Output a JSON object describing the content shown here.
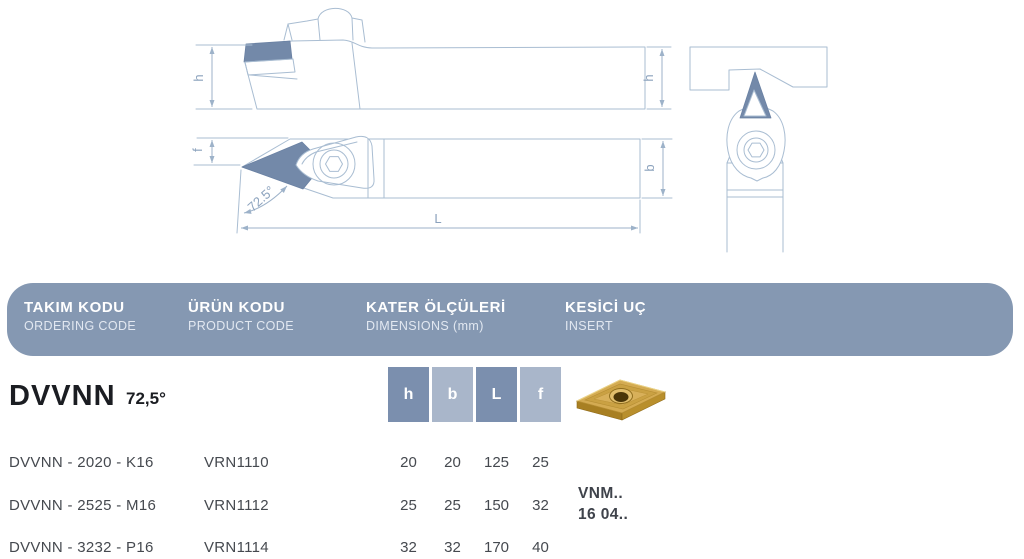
{
  "drawings": {
    "side_view": {
      "dim_left": "h",
      "dim_right": "h"
    },
    "top_view": {
      "dim_f": "f",
      "dim_b": "b",
      "dim_length": "L",
      "angle": "72.5°"
    },
    "line_color": "#a9bdd2",
    "insert_fill_color": "#7389a9"
  },
  "header": {
    "bg_color": "#8598b2",
    "columns": [
      {
        "title": "TAKIM KODU",
        "subtitle": "ORDERING CODE"
      },
      {
        "title": "ÜRÜN KODU",
        "subtitle": "PRODUCT CODE"
      },
      {
        "title": "KATER ÖLÇÜLERİ",
        "subtitle": "DIMENSIONS (mm)"
      },
      {
        "title": "KESİCİ UÇ",
        "subtitle": "INSERT"
      }
    ]
  },
  "series": {
    "code": "DVVNN",
    "angle": "72,5°"
  },
  "dim_headers": [
    {
      "label": "h",
      "shade": "dark"
    },
    {
      "label": "b",
      "shade": "light"
    },
    {
      "label": "L",
      "shade": "dark"
    },
    {
      "label": "f",
      "shade": "light"
    }
  ],
  "insert": {
    "photo": "gold-vnmg-insert",
    "code_line1": "VNM..",
    "code_line2": "16 04.."
  },
  "table": {
    "rows": [
      {
        "ordering_code": "DVVNN - 2020 - K16",
        "product_code": "VRN1110",
        "dims": [
          "20",
          "20",
          "125",
          "25"
        ]
      },
      {
        "ordering_code": "DVVNN - 2525 - M16",
        "product_code": "VRN1112",
        "dims": [
          "25",
          "25",
          "150",
          "32"
        ]
      },
      {
        "ordering_code": "DVVNN - 3232 - P16",
        "product_code": "VRN1114",
        "dims": [
          "32",
          "32",
          "170",
          "40"
        ]
      }
    ]
  },
  "colors": {
    "header_bg": "#8598b2",
    "box_dark": "#7b8fae",
    "box_light": "#a9b6ca",
    "row_text": "#45494f",
    "title_text": "#1b1d22",
    "drawing_line": "#a9bdd2",
    "drawing_fill": "#7389a9",
    "insert_gold": "#d4ab52"
  }
}
